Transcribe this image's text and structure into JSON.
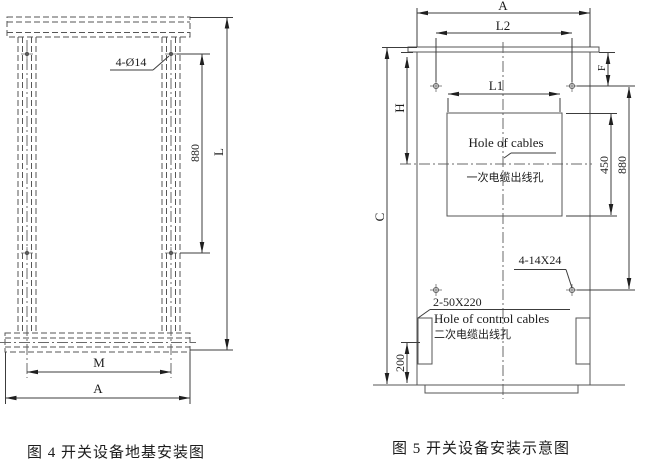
{
  "colors": {
    "background": "#ffffff",
    "line": "#565656",
    "dimension_line": "#3c3c3c",
    "text": "#1c1c1c"
  },
  "figure4": {
    "caption": "图 4 开关设备地基安装图",
    "labels": {
      "hole_callout": "4-Ø14",
      "dim_880": "880",
      "dim_L": "L",
      "dim_M": "M",
      "dim_A": "A"
    }
  },
  "figure5": {
    "caption": "图 5 开关设备安装示意图",
    "labels": {
      "dim_A": "A",
      "dim_L2": "L2",
      "dim_L1": "L1",
      "dim_F": "F",
      "dim_H": "H",
      "dim_C": "C",
      "dim_450": "450",
      "dim_880": "880",
      "dim_200": "200",
      "cable_hole_en": "Hole of cables",
      "cable_hole_cn": "一次电缆出线孔",
      "bolt_callout": "4-14X24",
      "slot_callout": "2-50X220",
      "control_hole_en": "Hole of control cables",
      "control_hole_cn": "二次电缆出线孔"
    }
  }
}
